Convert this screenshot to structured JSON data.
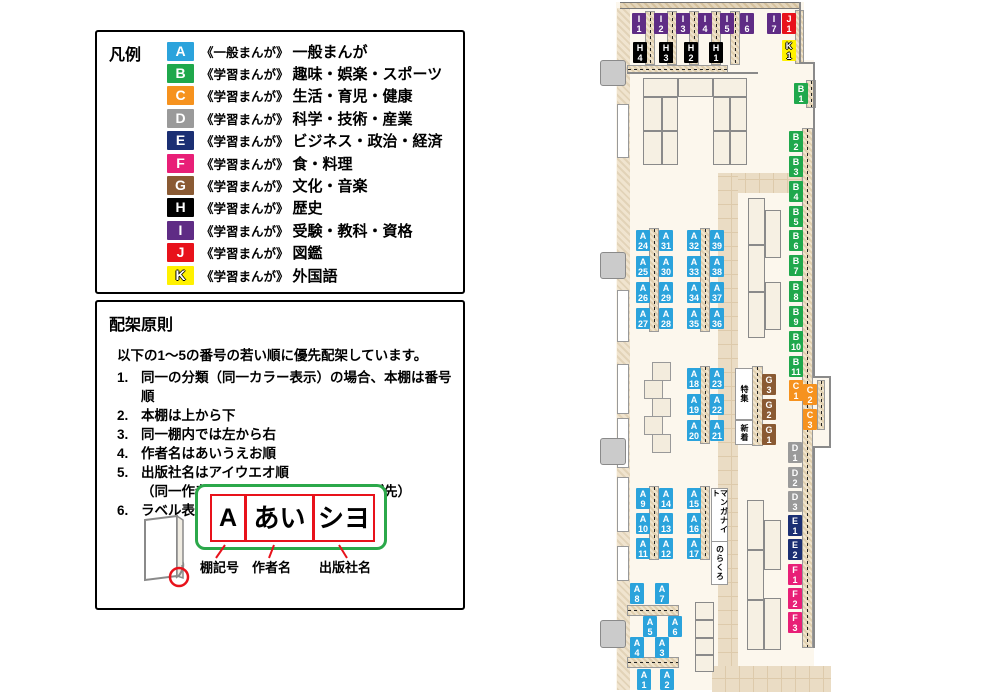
{
  "colors": {
    "A": "#2BA3DC",
    "B": "#1FA84C",
    "C": "#F6921E",
    "D": "#9A9A9A",
    "E": "#1B2F73",
    "F": "#E81F77",
    "G": "#8A5A33",
    "H": "#000000",
    "I": "#5F2C85",
    "J": "#E8121B",
    "K": "#FFF100"
  },
  "legend": {
    "title": "凡例",
    "items": [
      {
        "code": "A",
        "series": "《一般まんが》",
        "category": "一般まんが"
      },
      {
        "code": "B",
        "series": "《学習まんが》",
        "category": "趣味・娯楽・スポーツ"
      },
      {
        "code": "C",
        "series": "《学習まんが》",
        "category": "生活・育児・健康"
      },
      {
        "code": "D",
        "series": "《学習まんが》",
        "category": "科学・技術・産業"
      },
      {
        "code": "E",
        "series": "《学習まんが》",
        "category": "ビジネス・政治・経済"
      },
      {
        "code": "F",
        "series": "《学習まんが》",
        "category": "食・料理"
      },
      {
        "code": "G",
        "series": "《学習まんが》",
        "category": "文化・音楽"
      },
      {
        "code": "H",
        "series": "《学習まんが》",
        "category": "歴史"
      },
      {
        "code": "I",
        "series": "《学習まんが》",
        "category": "受験・教科・資格"
      },
      {
        "code": "J",
        "series": "《学習まんが》",
        "category": "図鑑"
      },
      {
        "code": "K",
        "series": "《学習まんが》",
        "category": "外国語"
      }
    ]
  },
  "principles": {
    "title": "配架原則",
    "intro": "以下の1～5の番号の若い順に優先配架しています。",
    "rules": [
      {
        "num": "1.",
        "text": "同一の分類（同一カラー表示）の場合、本棚は番号順"
      },
      {
        "num": "2.",
        "text": "本棚は上から下"
      },
      {
        "num": "3.",
        "text": "同一棚内では左から右"
      },
      {
        "num": "4.",
        "text": "作者名はあいうえお順"
      },
      {
        "num": "5.",
        "text": "出版社名はアイウエオ順",
        "sub": "（同一作者作品は出版時期の古いものが先）"
      },
      {
        "num": "6.",
        "text": "ラベル表記は下図の通り"
      }
    ],
    "label_diagram": {
      "boxes": [
        {
          "text": "A",
          "caption": "棚記号"
        },
        {
          "text": "あい",
          "caption": "作者名"
        },
        {
          "text": "シヨ",
          "caption": "出版社名"
        }
      ]
    }
  },
  "map": {
    "labels": [
      {
        "id": "I1",
        "letter": "I",
        "num": "1",
        "cat": "I",
        "x": 632,
        "y": 13
      },
      {
        "id": "I2",
        "letter": "I",
        "num": "2",
        "cat": "I",
        "x": 654,
        "y": 13
      },
      {
        "id": "I3",
        "letter": "I",
        "num": "3",
        "cat": "I",
        "x": 676,
        "y": 13
      },
      {
        "id": "I4",
        "letter": "I",
        "num": "4",
        "cat": "I",
        "x": 698,
        "y": 13
      },
      {
        "id": "I5",
        "letter": "I",
        "num": "5",
        "cat": "I",
        "x": 720,
        "y": 13
      },
      {
        "id": "I6",
        "letter": "I",
        "num": "6",
        "cat": "I",
        "x": 740,
        "y": 13
      },
      {
        "id": "I7",
        "letter": "I",
        "num": "7",
        "cat": "I",
        "x": 767,
        "y": 13
      },
      {
        "id": "J1",
        "letter": "J",
        "num": "1",
        "cat": "J",
        "x": 782,
        "y": 13
      },
      {
        "id": "K1",
        "letter": "K",
        "num": "1",
        "cat": "K",
        "x": 782,
        "y": 40
      },
      {
        "id": "H4",
        "letter": "H",
        "num": "4",
        "cat": "H",
        "x": 633,
        "y": 42
      },
      {
        "id": "H3",
        "letter": "H",
        "num": "3",
        "cat": "H",
        "x": 659,
        "y": 42
      },
      {
        "id": "H2",
        "letter": "H",
        "num": "2",
        "cat": "H",
        "x": 684,
        "y": 42
      },
      {
        "id": "H1",
        "letter": "H",
        "num": "1",
        "cat": "H",
        "x": 709,
        "y": 42
      },
      {
        "id": "B1",
        "letter": "B",
        "num": "1",
        "cat": "B",
        "x": 794,
        "y": 83
      },
      {
        "id": "B2",
        "letter": "B",
        "num": "2",
        "cat": "B",
        "x": 789,
        "y": 131
      },
      {
        "id": "B3",
        "letter": "B",
        "num": "3",
        "cat": "B",
        "x": 789,
        "y": 156
      },
      {
        "id": "B4",
        "letter": "B",
        "num": "4",
        "cat": "B",
        "x": 789,
        "y": 181
      },
      {
        "id": "B5",
        "letter": "B",
        "num": "5",
        "cat": "B",
        "x": 789,
        "y": 206
      },
      {
        "id": "B6",
        "letter": "B",
        "num": "6",
        "cat": "B",
        "x": 789,
        "y": 230
      },
      {
        "id": "B7",
        "letter": "B",
        "num": "7",
        "cat": "B",
        "x": 789,
        "y": 255
      },
      {
        "id": "B8",
        "letter": "B",
        "num": "8",
        "cat": "B",
        "x": 789,
        "y": 281
      },
      {
        "id": "B9",
        "letter": "B",
        "num": "9",
        "cat": "B",
        "x": 789,
        "y": 306
      },
      {
        "id": "B10",
        "letter": "B",
        "num": "10",
        "cat": "B",
        "x": 789,
        "y": 331
      },
      {
        "id": "B11",
        "letter": "B",
        "num": "11",
        "cat": "B",
        "x": 789,
        "y": 356
      },
      {
        "id": "C1",
        "letter": "C",
        "num": "1",
        "cat": "C",
        "x": 789,
        "y": 380
      },
      {
        "id": "C2",
        "letter": "C",
        "num": "2",
        "cat": "C",
        "x": 803,
        "y": 384
      },
      {
        "id": "C3",
        "letter": "C",
        "num": "3",
        "cat": "C",
        "x": 803,
        "y": 409
      },
      {
        "id": "D1",
        "letter": "D",
        "num": "1",
        "cat": "D",
        "x": 788,
        "y": 442
      },
      {
        "id": "D2",
        "letter": "D",
        "num": "2",
        "cat": "D",
        "x": 788,
        "y": 467
      },
      {
        "id": "D3",
        "letter": "D",
        "num": "3",
        "cat": "D",
        "x": 788,
        "y": 491
      },
      {
        "id": "E1",
        "letter": "E",
        "num": "1",
        "cat": "E",
        "x": 788,
        "y": 515
      },
      {
        "id": "E2",
        "letter": "E",
        "num": "2",
        "cat": "E",
        "x": 788,
        "y": 539
      },
      {
        "id": "F1",
        "letter": "F",
        "num": "1",
        "cat": "F",
        "x": 788,
        "y": 564
      },
      {
        "id": "F2",
        "letter": "F",
        "num": "2",
        "cat": "F",
        "x": 788,
        "y": 588
      },
      {
        "id": "F3",
        "letter": "F",
        "num": "3",
        "cat": "F",
        "x": 788,
        "y": 612
      },
      {
        "id": "G3",
        "letter": "G",
        "num": "3",
        "cat": "G",
        "x": 762,
        "y": 374
      },
      {
        "id": "G2",
        "letter": "G",
        "num": "2",
        "cat": "G",
        "x": 762,
        "y": 399
      },
      {
        "id": "G1",
        "letter": "G",
        "num": "1",
        "cat": "G",
        "x": 762,
        "y": 424
      },
      {
        "id": "A24",
        "letter": "A",
        "num": "24",
        "cat": "A",
        "x": 636,
        "y": 230
      },
      {
        "id": "A31",
        "letter": "A",
        "num": "31",
        "cat": "A",
        "x": 659,
        "y": 230
      },
      {
        "id": "A32",
        "letter": "A",
        "num": "32",
        "cat": "A",
        "x": 687,
        "y": 230
      },
      {
        "id": "A39",
        "letter": "A",
        "num": "39",
        "cat": "A",
        "x": 710,
        "y": 230
      },
      {
        "id": "A25",
        "letter": "A",
        "num": "25",
        "cat": "A",
        "x": 636,
        "y": 256
      },
      {
        "id": "A30",
        "letter": "A",
        "num": "30",
        "cat": "A",
        "x": 659,
        "y": 256
      },
      {
        "id": "A33",
        "letter": "A",
        "num": "33",
        "cat": "A",
        "x": 687,
        "y": 256
      },
      {
        "id": "A38",
        "letter": "A",
        "num": "38",
        "cat": "A",
        "x": 710,
        "y": 256
      },
      {
        "id": "A26",
        "letter": "A",
        "num": "26",
        "cat": "A",
        "x": 636,
        "y": 282
      },
      {
        "id": "A29",
        "letter": "A",
        "num": "29",
        "cat": "A",
        "x": 659,
        "y": 282
      },
      {
        "id": "A34",
        "letter": "A",
        "num": "34",
        "cat": "A",
        "x": 687,
        "y": 282
      },
      {
        "id": "A37",
        "letter": "A",
        "num": "37",
        "cat": "A",
        "x": 710,
        "y": 282
      },
      {
        "id": "A27",
        "letter": "A",
        "num": "27",
        "cat": "A",
        "x": 636,
        "y": 308
      },
      {
        "id": "A28",
        "letter": "A",
        "num": "28",
        "cat": "A",
        "x": 659,
        "y": 308
      },
      {
        "id": "A35",
        "letter": "A",
        "num": "35",
        "cat": "A",
        "x": 687,
        "y": 308
      },
      {
        "id": "A36",
        "letter": "A",
        "num": "36",
        "cat": "A",
        "x": 710,
        "y": 308
      },
      {
        "id": "A18",
        "letter": "A",
        "num": "18",
        "cat": "A",
        "x": 687,
        "y": 368
      },
      {
        "id": "A23",
        "letter": "A",
        "num": "23",
        "cat": "A",
        "x": 710,
        "y": 368
      },
      {
        "id": "A19",
        "letter": "A",
        "num": "19",
        "cat": "A",
        "x": 687,
        "y": 394
      },
      {
        "id": "A22",
        "letter": "A",
        "num": "22",
        "cat": "A",
        "x": 710,
        "y": 394
      },
      {
        "id": "A20",
        "letter": "A",
        "num": "20",
        "cat": "A",
        "x": 687,
        "y": 420
      },
      {
        "id": "A21",
        "letter": "A",
        "num": "21",
        "cat": "A",
        "x": 710,
        "y": 420
      },
      {
        "id": "A9",
        "letter": "A",
        "num": "9",
        "cat": "A",
        "x": 636,
        "y": 488
      },
      {
        "id": "A14",
        "letter": "A",
        "num": "14",
        "cat": "A",
        "x": 659,
        "y": 488
      },
      {
        "id": "A15",
        "letter": "A",
        "num": "15",
        "cat": "A",
        "x": 687,
        "y": 488
      },
      {
        "id": "A10",
        "letter": "A",
        "num": "10",
        "cat": "A",
        "x": 636,
        "y": 513
      },
      {
        "id": "A13",
        "letter": "A",
        "num": "13",
        "cat": "A",
        "x": 659,
        "y": 513
      },
      {
        "id": "A16",
        "letter": "A",
        "num": "16",
        "cat": "A",
        "x": 687,
        "y": 513
      },
      {
        "id": "A11",
        "letter": "A",
        "num": "11",
        "cat": "A",
        "x": 636,
        "y": 538
      },
      {
        "id": "A12",
        "letter": "A",
        "num": "12",
        "cat": "A",
        "x": 659,
        "y": 538
      },
      {
        "id": "A17",
        "letter": "A",
        "num": "17",
        "cat": "A",
        "x": 687,
        "y": 538
      },
      {
        "id": "A8",
        "letter": "A",
        "num": "8",
        "cat": "A",
        "x": 630,
        "y": 583
      },
      {
        "id": "A7",
        "letter": "A",
        "num": "7",
        "cat": "A",
        "x": 655,
        "y": 583
      },
      {
        "id": "A5",
        "letter": "A",
        "num": "5",
        "cat": "A",
        "x": 643,
        "y": 616
      },
      {
        "id": "A6",
        "letter": "A",
        "num": "6",
        "cat": "A",
        "x": 668,
        "y": 616
      },
      {
        "id": "A4",
        "letter": "A",
        "num": "4",
        "cat": "A",
        "x": 630,
        "y": 637
      },
      {
        "id": "A3",
        "letter": "A",
        "num": "3",
        "cat": "A",
        "x": 655,
        "y": 637
      },
      {
        "id": "A1",
        "letter": "A",
        "num": "1",
        "cat": "A",
        "x": 637,
        "y": 669
      },
      {
        "id": "A2",
        "letter": "A",
        "num": "2",
        "cat": "A",
        "x": 660,
        "y": 669
      }
    ],
    "text_boxes": [
      {
        "id": "tokushu",
        "text": "特集",
        "x": 735,
        "y": 368,
        "w": 16,
        "h": 50
      },
      {
        "id": "shinchaku",
        "text": "新着",
        "x": 735,
        "y": 420,
        "w": 16,
        "h": 23
      },
      {
        "id": "manganight",
        "text": "マンガナイト",
        "x": 711,
        "y": 488,
        "w": 15,
        "h": 53
      },
      {
        "id": "norakuro",
        "text": "のらくろ",
        "x": 711,
        "y": 541,
        "w": 15,
        "h": 42
      }
    ]
  }
}
